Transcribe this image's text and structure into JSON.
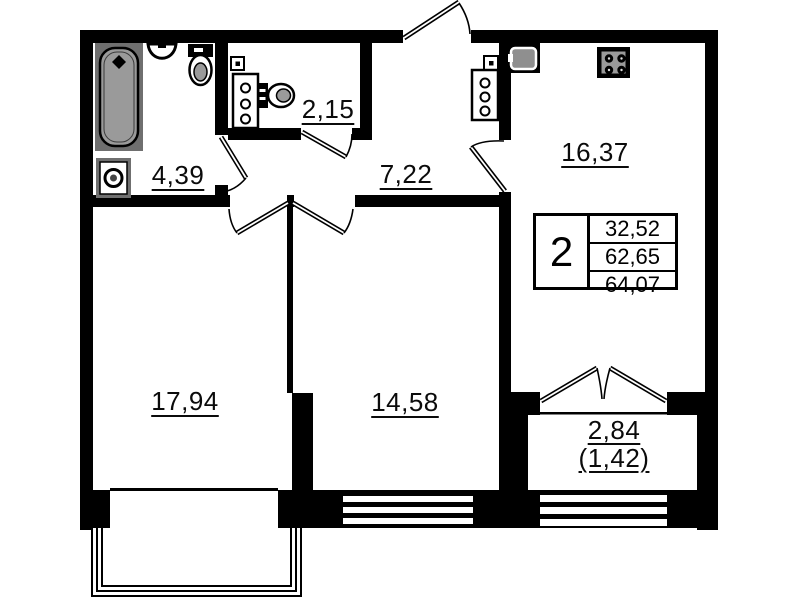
{
  "plan": {
    "title": "2-room apartment floor plan",
    "rooms": [
      {
        "id": "living-room",
        "area": "17,94"
      },
      {
        "id": "bedroom",
        "area": "14,58"
      },
      {
        "id": "kitchen",
        "area": "16,37"
      },
      {
        "id": "hallway",
        "area": "7,22"
      },
      {
        "id": "bathroom",
        "area": "4,39"
      },
      {
        "id": "wc",
        "area": "2,15"
      },
      {
        "id": "balcony",
        "area": "2,84",
        "area_coefficient": "(1,42)"
      }
    ],
    "summary": {
      "rooms_count": "2",
      "living_area": "32,52",
      "apartment_area": "62,65",
      "total_area": "64,07"
    },
    "fixtures": [
      "bathtub",
      "washing-machine",
      "bath-sink",
      "toilet",
      "wc-toilet",
      "meter-box",
      "ventilation-shaft",
      "kitchen-sink",
      "stove"
    ],
    "colors": {
      "walls": "#000000",
      "background": "#ffffff",
      "fixture_gray": "#9a9a9a",
      "fixture_dark": "#6f6f6f"
    }
  }
}
